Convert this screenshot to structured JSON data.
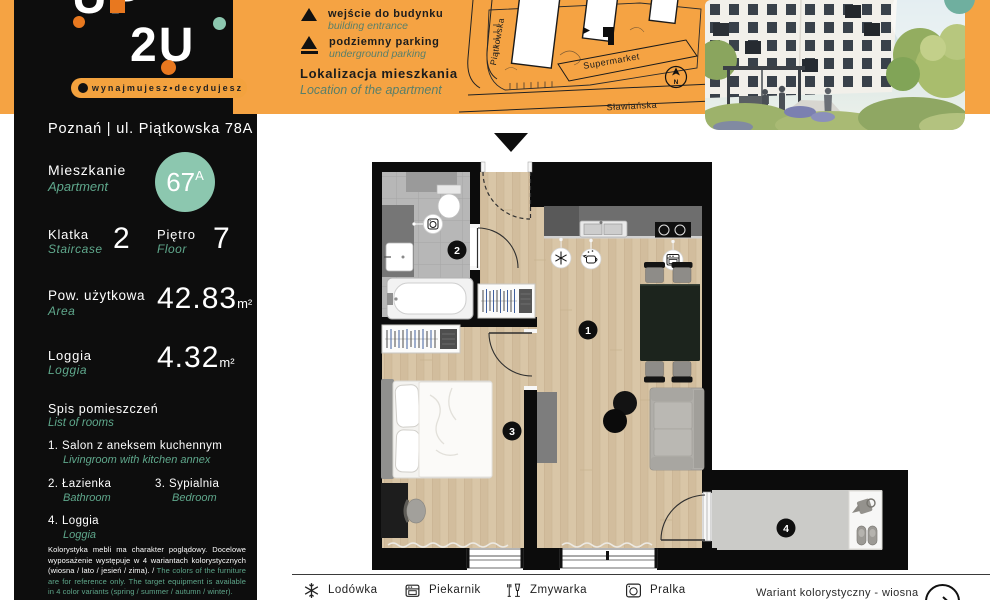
{
  "colors": {
    "orange": "#F5A343",
    "black_panel": "#0D0D0D",
    "teal_accent": "#8CC7AF",
    "teal_text": "#5FA88C",
    "legend_green": "#587F6A",
    "wood_floor": "#D8C5A6",
    "tile_gray": "#B7B7B7"
  },
  "brand": {
    "logo_top": "UP",
    "logo_bottom": "2U",
    "tagline": "wynajmujesz•decydujesz"
  },
  "sidebar": {
    "address": "Poznań | ul. Piątkowska 78A",
    "apartment_label_pl": "Mieszkanie",
    "apartment_label_en": "Apartment",
    "apartment_number": "67",
    "apartment_number_suffix": "A",
    "staircase_label_pl": "Klatka",
    "staircase_label_en": "Staircase",
    "staircase_value": "2",
    "floor_label_pl": "Piętro",
    "floor_label_en": "Floor",
    "floor_value": "7",
    "area_label_pl": "Pow. użytkowa",
    "area_label_en": "Area",
    "area_value": "42.83",
    "area_unit": "m²",
    "loggia_label_pl": "Loggia",
    "loggia_label_en": "Loggia",
    "loggia_value": "4.32",
    "loggia_unit": "m²",
    "rooms_header_pl": "Spis pomieszczeń",
    "rooms_header_en": "List of rooms",
    "rooms": [
      {
        "num": "1.",
        "pl": "Salon z aneksem kuchennym",
        "en": "Livingroom with kitchen annex"
      },
      {
        "num": "2.",
        "pl": "Łazienka",
        "en": "Bathroom"
      },
      {
        "num": "3.",
        "pl": "Sypialnia",
        "en": "Bedroom"
      },
      {
        "num": "4.",
        "pl": "Loggia",
        "en": "Loggia"
      }
    ],
    "disclaimer_pl": "Kolorystyka mebli ma charakter poglądowy. Docelowe wyposażenie występuje w 4 wariantach kolorystycznych (wiosna / lato / jesień / zima). / ",
    "disclaimer_en": "The colors of the furniture are for reference only. The target equipment is available in 4 color variants (spring / summer / autumn / winter)."
  },
  "map": {
    "legend": [
      {
        "pl": "wejście do budynku",
        "en": "building entrance"
      },
      {
        "pl": "podziemny parking",
        "en": "underground parking"
      }
    ],
    "title_pl": "Lokalizacja mieszkania",
    "title_en": "Location of the apartment",
    "street_left": "Piątkowska",
    "street_bottom": "Sławiańska",
    "supermarket": "Supermarket",
    "compass": "N"
  },
  "plan": {
    "room_badges": [
      "1",
      "2",
      "3",
      "4"
    ]
  },
  "bottom_bar": {
    "appliances": [
      {
        "name": "Lodówka"
      },
      {
        "name": "Piekarnik"
      },
      {
        "name": "Zmywarka"
      },
      {
        "name": "Pralka"
      }
    ],
    "variant_label": "Wariant kolorystyczny - wiosna"
  }
}
